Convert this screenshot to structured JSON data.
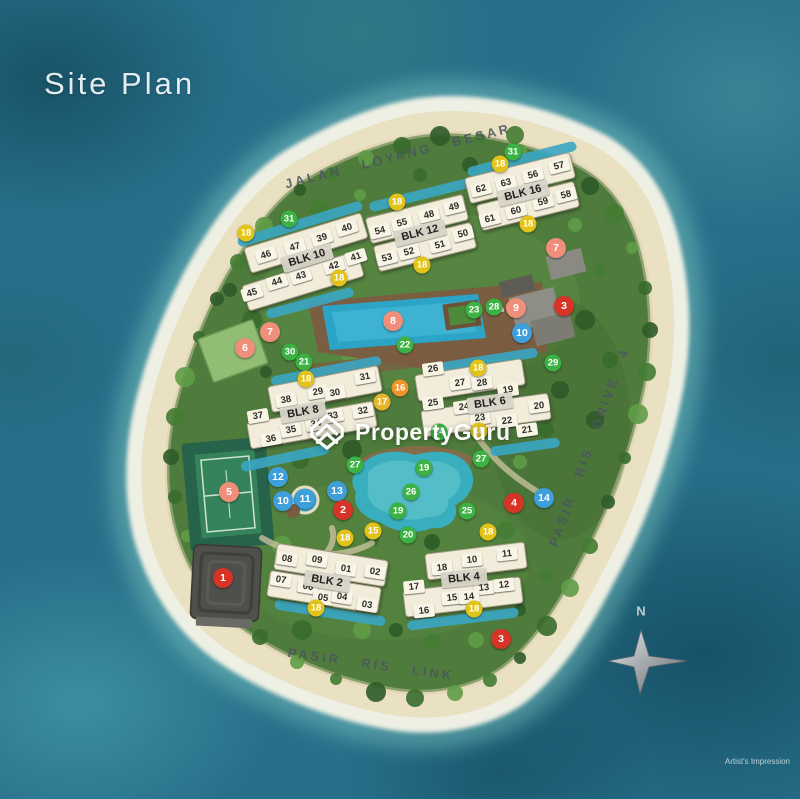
{
  "title": "Site Plan",
  "watermark": {
    "brand": "PropertyGuru"
  },
  "note": "Artist's Impression",
  "compass": {
    "label": "N"
  },
  "roads": [
    {
      "name": "JALAN LOYANG BESAR",
      "x": 398,
      "y": 156,
      "rotate": -14
    },
    {
      "name": "PASIR RIS DRIVE 4",
      "x": 589,
      "y": 447,
      "rotate": -70
    },
    {
      "name": "PASIR RIS LINK",
      "x": 371,
      "y": 664,
      "rotate": 8
    }
  ],
  "blocks": [
    {
      "label": "BLK 10",
      "x": 307,
      "y": 258,
      "rotate": -17
    },
    {
      "label": "BLK 12",
      "x": 420,
      "y": 233,
      "rotate": -14
    },
    {
      "label": "BLK 16",
      "x": 523,
      "y": 193,
      "rotate": -14
    },
    {
      "label": "BLK 8",
      "x": 303,
      "y": 412,
      "rotate": -10
    },
    {
      "label": "BLK 6",
      "x": 490,
      "y": 403,
      "rotate": -8
    },
    {
      "label": "BLK 2",
      "x": 327,
      "y": 581,
      "rotate": 9
    },
    {
      "label": "BLK 4",
      "x": 464,
      "y": 578,
      "rotate": -6
    }
  ],
  "units": [
    {
      "n": "46",
      "x": 266,
      "y": 255,
      "r": -17
    },
    {
      "n": "47",
      "x": 295,
      "y": 247,
      "r": -17
    },
    {
      "n": "39",
      "x": 322,
      "y": 238,
      "r": -17
    },
    {
      "n": "40",
      "x": 347,
      "y": 228,
      "r": -17
    },
    {
      "n": "41",
      "x": 356,
      "y": 257,
      "r": -17
    },
    {
      "n": "42",
      "x": 334,
      "y": 266,
      "r": -17
    },
    {
      "n": "43",
      "x": 301,
      "y": 276,
      "r": -17
    },
    {
      "n": "44",
      "x": 277,
      "y": 282,
      "r": -17
    },
    {
      "n": "45",
      "x": 252,
      "y": 293,
      "r": -17
    },
    {
      "n": "54",
      "x": 380,
      "y": 231,
      "r": -14
    },
    {
      "n": "55",
      "x": 402,
      "y": 223,
      "r": -14
    },
    {
      "n": "48",
      "x": 429,
      "y": 215,
      "r": -14
    },
    {
      "n": "49",
      "x": 454,
      "y": 207,
      "r": -14
    },
    {
      "n": "53",
      "x": 387,
      "y": 258,
      "r": -14
    },
    {
      "n": "52",
      "x": 409,
      "y": 252,
      "r": -14
    },
    {
      "n": "51",
      "x": 440,
      "y": 245,
      "r": -14
    },
    {
      "n": "50",
      "x": 463,
      "y": 234,
      "r": -14
    },
    {
      "n": "62",
      "x": 481,
      "y": 189,
      "r": -14
    },
    {
      "n": "63",
      "x": 506,
      "y": 183,
      "r": -14
    },
    {
      "n": "56",
      "x": 533,
      "y": 175,
      "r": -14
    },
    {
      "n": "57",
      "x": 559,
      "y": 166,
      "r": -14
    },
    {
      "n": "58",
      "x": 566,
      "y": 195,
      "r": -14
    },
    {
      "n": "59",
      "x": 543,
      "y": 202,
      "r": -14
    },
    {
      "n": "60",
      "x": 516,
      "y": 211,
      "r": -14
    },
    {
      "n": "61",
      "x": 490,
      "y": 219,
      "r": -14
    },
    {
      "n": "38",
      "x": 286,
      "y": 400,
      "r": -10
    },
    {
      "n": "29",
      "x": 318,
      "y": 392,
      "r": -10
    },
    {
      "n": "30",
      "x": 335,
      "y": 393,
      "r": -10
    },
    {
      "n": "31",
      "x": 365,
      "y": 377,
      "r": -10
    },
    {
      "n": "37",
      "x": 258,
      "y": 416,
      "r": -10
    },
    {
      "n": "33",
      "x": 333,
      "y": 416,
      "r": -10
    },
    {
      "n": "32",
      "x": 363,
      "y": 411,
      "r": -10
    },
    {
      "n": "34",
      "x": 316,
      "y": 424,
      "r": -10
    },
    {
      "n": "35",
      "x": 291,
      "y": 430,
      "r": -10
    },
    {
      "n": "36",
      "x": 271,
      "y": 439,
      "r": -10
    },
    {
      "n": "26",
      "x": 433,
      "y": 369,
      "r": -8
    },
    {
      "n": "27",
      "x": 460,
      "y": 383,
      "r": -8
    },
    {
      "n": "28",
      "x": 482,
      "y": 383,
      "r": -8
    },
    {
      "n": "19",
      "x": 508,
      "y": 390,
      "r": -8
    },
    {
      "n": "25",
      "x": 433,
      "y": 403,
      "r": -8
    },
    {
      "n": "24",
      "x": 464,
      "y": 407,
      "r": -8
    },
    {
      "n": "23",
      "x": 480,
      "y": 418,
      "r": -8
    },
    {
      "n": "22",
      "x": 507,
      "y": 421,
      "r": -8
    },
    {
      "n": "20",
      "x": 539,
      "y": 406,
      "r": -8
    },
    {
      "n": "21",
      "x": 527,
      "y": 430,
      "r": -8
    },
    {
      "n": "08",
      "x": 287,
      "y": 559,
      "r": 9
    },
    {
      "n": "09",
      "x": 317,
      "y": 560,
      "r": 9
    },
    {
      "n": "01",
      "x": 346,
      "y": 569,
      "r": 9
    },
    {
      "n": "02",
      "x": 375,
      "y": 572,
      "r": 9
    },
    {
      "n": "07",
      "x": 281,
      "y": 580,
      "r": 9
    },
    {
      "n": "06",
      "x": 308,
      "y": 587,
      "r": 9
    },
    {
      "n": "05",
      "x": 323,
      "y": 598,
      "r": 9
    },
    {
      "n": "04",
      "x": 342,
      "y": 597,
      "r": 9
    },
    {
      "n": "03",
      "x": 367,
      "y": 605,
      "r": 9
    },
    {
      "n": "18",
      "x": 442,
      "y": 568,
      "r": -6
    },
    {
      "n": "10",
      "x": 472,
      "y": 560,
      "r": -6
    },
    {
      "n": "11",
      "x": 507,
      "y": 554,
      "r": -6
    },
    {
      "n": "17",
      "x": 414,
      "y": 587,
      "r": -6
    },
    {
      "n": "13",
      "x": 484,
      "y": 588,
      "r": -6
    },
    {
      "n": "12",
      "x": 504,
      "y": 585,
      "r": -6
    },
    {
      "n": "15",
      "x": 452,
      "y": 598,
      "r": -6
    },
    {
      "n": "14",
      "x": 469,
      "y": 597,
      "r": -6
    },
    {
      "n": "16",
      "x": 424,
      "y": 611,
      "r": -6
    }
  ],
  "markers": [
    {
      "n": "31",
      "x": 289,
      "y": 219,
      "c": "green"
    },
    {
      "n": "18",
      "x": 246,
      "y": 233,
      "c": "yellow"
    },
    {
      "n": "18",
      "x": 397,
      "y": 202,
      "c": "yellow"
    },
    {
      "n": "18",
      "x": 339,
      "y": 278,
      "c": "yellow"
    },
    {
      "n": "18",
      "x": 422,
      "y": 265,
      "c": "yellow"
    },
    {
      "n": "31",
      "x": 513,
      "y": 152,
      "c": "green"
    },
    {
      "n": "18",
      "x": 500,
      "y": 164,
      "c": "yellow"
    },
    {
      "n": "18",
      "x": 528,
      "y": 224,
      "c": "yellow"
    },
    {
      "n": "7",
      "x": 556,
      "y": 248,
      "c": "salmon"
    },
    {
      "n": "23",
      "x": 474,
      "y": 310,
      "c": "green"
    },
    {
      "n": "28",
      "x": 494,
      "y": 307,
      "c": "green"
    },
    {
      "n": "9",
      "x": 516,
      "y": 308,
      "c": "salmon"
    },
    {
      "n": "3",
      "x": 564,
      "y": 306,
      "c": "red"
    },
    {
      "n": "10",
      "x": 522,
      "y": 333,
      "c": "blue"
    },
    {
      "n": "29",
      "x": 553,
      "y": 363,
      "c": "green"
    },
    {
      "n": "18",
      "x": 478,
      "y": 368,
      "c": "yellow"
    },
    {
      "n": "7",
      "x": 270,
      "y": 332,
      "c": "salmon"
    },
    {
      "n": "6",
      "x": 245,
      "y": 348,
      "c": "salmon"
    },
    {
      "n": "30",
      "x": 290,
      "y": 352,
      "c": "green"
    },
    {
      "n": "21",
      "x": 304,
      "y": 362,
      "c": "green"
    },
    {
      "n": "18",
      "x": 306,
      "y": 379,
      "c": "yellow"
    },
    {
      "n": "8",
      "x": 393,
      "y": 321,
      "c": "salmon"
    },
    {
      "n": "22",
      "x": 405,
      "y": 345,
      "c": "green"
    },
    {
      "n": "16",
      "x": 400,
      "y": 388,
      "c": "orange"
    },
    {
      "n": "17",
      "x": 382,
      "y": 402,
      "c": "amber"
    },
    {
      "n": "18",
      "x": 479,
      "y": 431,
      "c": "yellow"
    },
    {
      "n": "24",
      "x": 439,
      "y": 432,
      "c": "green"
    },
    {
      "n": "27",
      "x": 355,
      "y": 465,
      "c": "green"
    },
    {
      "n": "19",
      "x": 424,
      "y": 468,
      "c": "green"
    },
    {
      "n": "26",
      "x": 411,
      "y": 492,
      "c": "green"
    },
    {
      "n": "27",
      "x": 481,
      "y": 459,
      "c": "green"
    },
    {
      "n": "19",
      "x": 398,
      "y": 511,
      "c": "green"
    },
    {
      "n": "25",
      "x": 467,
      "y": 511,
      "c": "green"
    },
    {
      "n": "4",
      "x": 514,
      "y": 503,
      "c": "red"
    },
    {
      "n": "14",
      "x": 544,
      "y": 498,
      "c": "blue"
    },
    {
      "n": "15",
      "x": 373,
      "y": 531,
      "c": "yellow"
    },
    {
      "n": "20",
      "x": 408,
      "y": 535,
      "c": "green"
    },
    {
      "n": "18",
      "x": 488,
      "y": 532,
      "c": "yellow"
    },
    {
      "n": "5",
      "x": 229,
      "y": 492,
      "c": "salmon"
    },
    {
      "n": "12",
      "x": 278,
      "y": 477,
      "c": "blue"
    },
    {
      "n": "10",
      "x": 283,
      "y": 501,
      "c": "blue"
    },
    {
      "n": "11",
      "x": 305,
      "y": 499,
      "c": "blue"
    },
    {
      "n": "13",
      "x": 337,
      "y": 491,
      "c": "blue"
    },
    {
      "n": "2",
      "x": 343,
      "y": 510,
      "c": "red"
    },
    {
      "n": "18",
      "x": 345,
      "y": 538,
      "c": "yellow"
    },
    {
      "n": "1",
      "x": 223,
      "y": 578,
      "c": "red"
    },
    {
      "n": "18",
      "x": 316,
      "y": 608,
      "c": "yellow"
    },
    {
      "n": "18",
      "x": 474,
      "y": 609,
      "c": "yellow"
    },
    {
      "n": "3",
      "x": 501,
      "y": 639,
      "c": "red"
    }
  ],
  "colors": {
    "red": "#d63426",
    "salmon": "#ef8f7b",
    "blue": "#3f9fdb",
    "yellow": "#e2c319",
    "orange": "#ee9429",
    "amber": "#e7b42b",
    "green": "#3cb244"
  }
}
